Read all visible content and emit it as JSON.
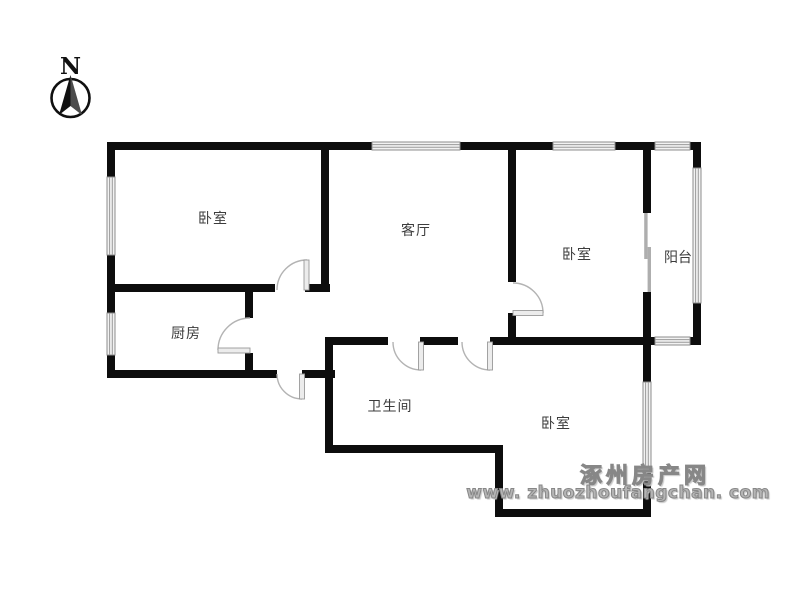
{
  "title": "apartment-floor-plan",
  "compass": {
    "label": "N"
  },
  "rooms": {
    "bedroom_nw": {
      "label": "卧室"
    },
    "living": {
      "label": "客厅"
    },
    "bedroom_ne": {
      "label": "卧室"
    },
    "balcony": {
      "label": "阳台"
    },
    "kitchen": {
      "label": "厨房"
    },
    "bathroom": {
      "label": "卫生间"
    },
    "bedroom_se": {
      "label": "卧室"
    }
  },
  "watermark": {
    "site_name": "涿州房产网",
    "site_url": "www. zhuozhoufangchan. com"
  },
  "colors": {
    "wall": "#0d0d0d",
    "window": "#9a9a9a",
    "door": "#b3b3b3",
    "label": "#3c3c3c",
    "watermark": "#8f8f8f"
  }
}
